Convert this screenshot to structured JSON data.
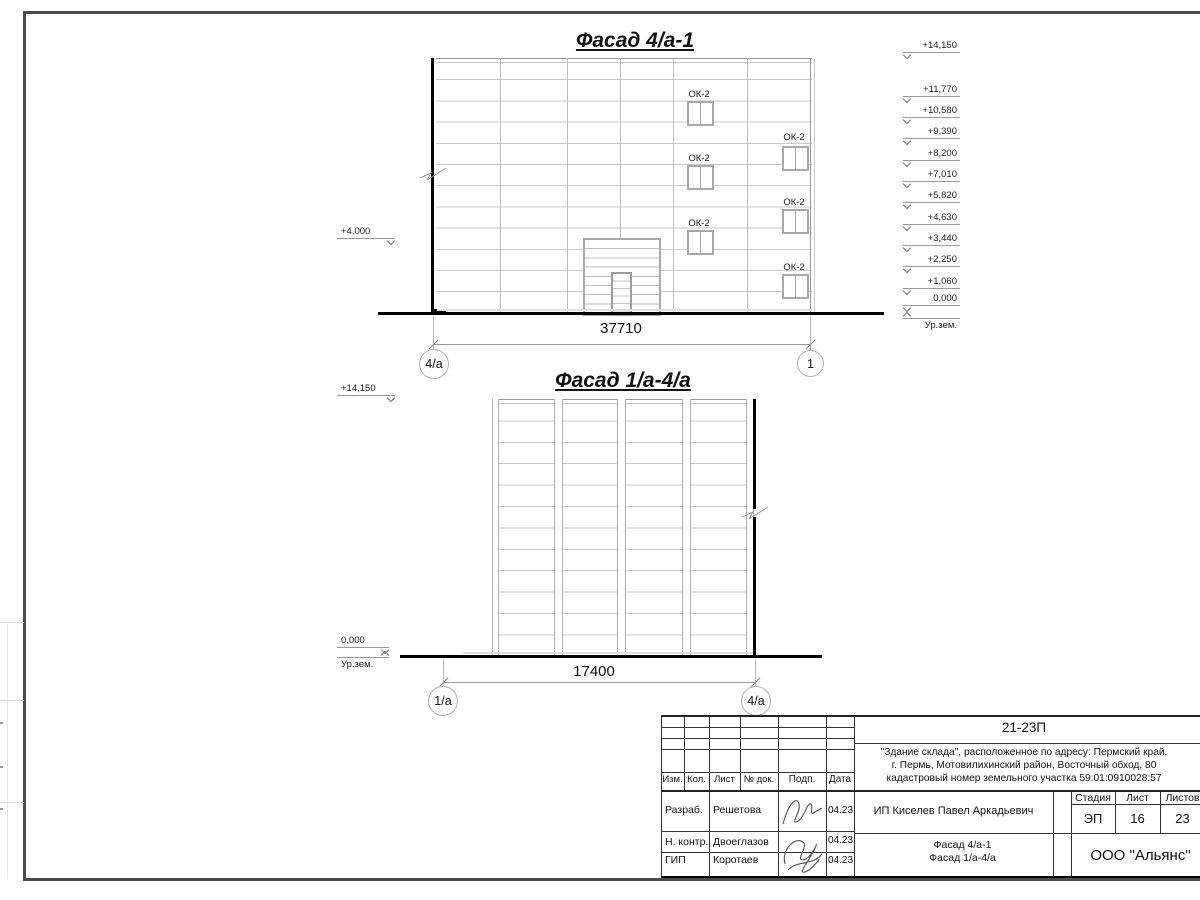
{
  "facade_top": {
    "title": "Фасад 4/а-1",
    "dimension": "37710",
    "axis_left": "4/а",
    "axis_right": "1",
    "window_label": "ОК-2",
    "elevation_left": "+4,000",
    "elevations_right": [
      "+14,150",
      "+11,770",
      "+10,580",
      "+9,390",
      "+8,200",
      "+7,010",
      "+5,820",
      "+4,630",
      "+3,440",
      "+2,250",
      "+1,060",
      "0,000"
    ],
    "ground_label": "Ур.зем."
  },
  "facade_bottom": {
    "title": "Фасад 1/а-4/а",
    "dimension": "17400",
    "axis_left": "1/а",
    "axis_right": "4/а",
    "elevation_top": "+14,150",
    "elevation_zero": "0,000",
    "ground_label": "Ур.зем."
  },
  "titleblock": {
    "code": "21-23П",
    "address_line1": "\"Здание склада\", расположенное по адресу: Пермский край,",
    "address_line2": "г. Пермь, Мотовилихинский район, Восточный обход, 80",
    "address_line3": "кадастровый номер земельного участка 59:01:0910028:57",
    "client": "ИП Киселев Павел Аркадьевич",
    "headers": {
      "izm": "Изм.",
      "kol": "Кол.",
      "list": "Лист",
      "doc": "№ док.",
      "podp": "Подп.",
      "date": "Дата",
      "stage": "Стадия",
      "sheet": "Лист",
      "sheets": "Листов"
    },
    "stage_value": "ЭП",
    "sheet_value": "16",
    "sheets_value": "23",
    "rows": [
      {
        "role": "Разраб.",
        "name": "Решетова",
        "date": "04.23"
      },
      {
        "role": "Н. контр.",
        "name": "Двоеглазов",
        "date": "04.23"
      },
      {
        "role": "ГИП",
        "name": "Коротаев",
        "date": "04.23"
      }
    ],
    "doc_title_line1": "Фасад 4/а-1",
    "doc_title_line2": "Фасад 1/а-4/а",
    "company": "ООО \"Альянс\""
  },
  "colors": {
    "line_strong": "#000000",
    "line_thin": "#9a9a9a",
    "panel_line": "#c9c9c9"
  }
}
